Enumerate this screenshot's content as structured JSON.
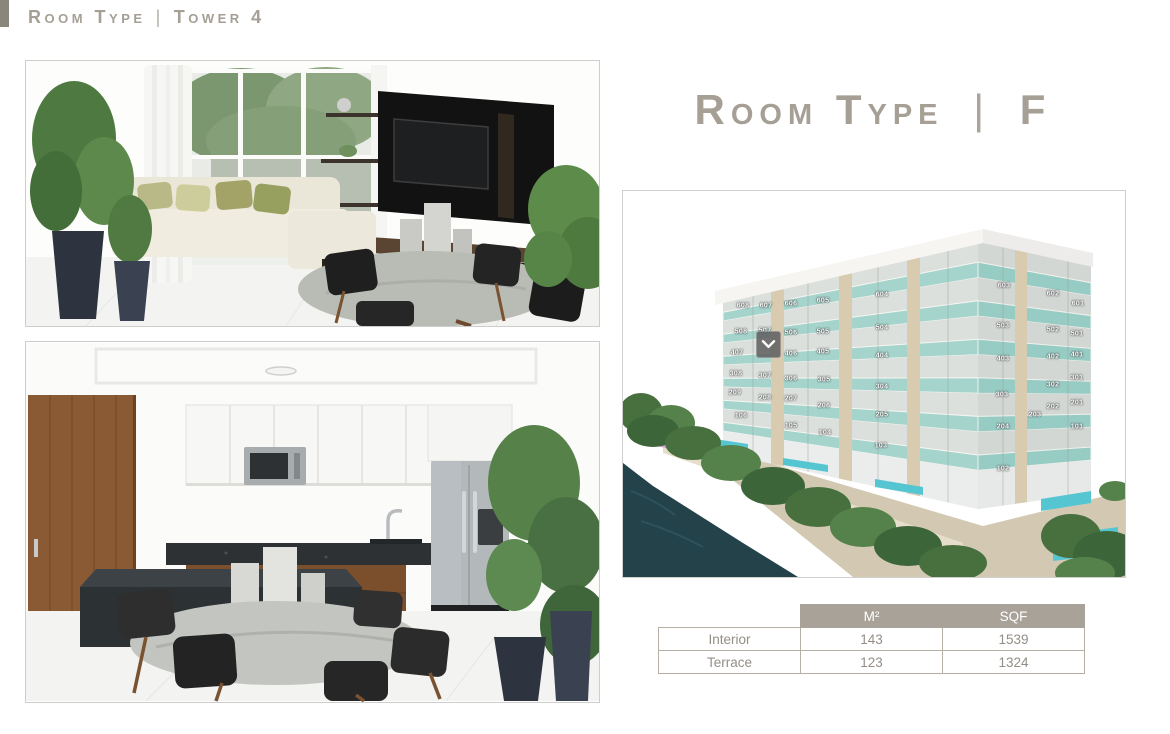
{
  "header": {
    "title_main": "Room Type",
    "divider": "|",
    "title_sub": "Tower 4"
  },
  "room": {
    "title_main": "Room Type",
    "divider": "|",
    "title_variant": "F"
  },
  "building": {
    "chevron_icon": "chevron-down",
    "units": [
      {
        "label": "608",
        "x": 120,
        "y": 115
      },
      {
        "label": "607",
        "x": 143,
        "y": 115
      },
      {
        "label": "606",
        "x": 168,
        "y": 113
      },
      {
        "label": "605",
        "x": 200,
        "y": 110
      },
      {
        "label": "604",
        "x": 259,
        "y": 104
      },
      {
        "label": "603",
        "x": 381,
        "y": 95
      },
      {
        "label": "602",
        "x": 430,
        "y": 103
      },
      {
        "label": "601",
        "x": 455,
        "y": 113
      },
      {
        "label": "508",
        "x": 118,
        "y": 141
      },
      {
        "label": "507",
        "x": 142,
        "y": 140
      },
      {
        "label": "506",
        "x": 168,
        "y": 142
      },
      {
        "label": "505",
        "x": 200,
        "y": 141
      },
      {
        "label": "504",
        "x": 259,
        "y": 137
      },
      {
        "label": "503",
        "x": 380,
        "y": 135
      },
      {
        "label": "502",
        "x": 430,
        "y": 139
      },
      {
        "label": "501",
        "x": 454,
        "y": 143
      },
      {
        "label": "407",
        "x": 114,
        "y": 162
      },
      {
        "label": "406",
        "x": 168,
        "y": 163
      },
      {
        "label": "405",
        "x": 200,
        "y": 161
      },
      {
        "label": "404",
        "x": 259,
        "y": 165
      },
      {
        "label": "403",
        "x": 380,
        "y": 168
      },
      {
        "label": "402",
        "x": 430,
        "y": 166
      },
      {
        "label": "401",
        "x": 454,
        "y": 164
      },
      {
        "label": "308",
        "x": 113,
        "y": 183
      },
      {
        "label": "307",
        "x": 142,
        "y": 185
      },
      {
        "label": "306",
        "x": 168,
        "y": 188
      },
      {
        "label": "305",
        "x": 201,
        "y": 189
      },
      {
        "label": "304",
        "x": 259,
        "y": 196
      },
      {
        "label": "303",
        "x": 379,
        "y": 204
      },
      {
        "label": "302",
        "x": 430,
        "y": 194
      },
      {
        "label": "301",
        "x": 454,
        "y": 187
      },
      {
        "label": "209",
        "x": 112,
        "y": 202
      },
      {
        "label": "208",
        "x": 142,
        "y": 207
      },
      {
        "label": "207",
        "x": 168,
        "y": 208
      },
      {
        "label": "206",
        "x": 201,
        "y": 215
      },
      {
        "label": "205",
        "x": 259,
        "y": 224
      },
      {
        "label": "204",
        "x": 380,
        "y": 236
      },
      {
        "label": "203",
        "x": 412,
        "y": 224
      },
      {
        "label": "202",
        "x": 430,
        "y": 216
      },
      {
        "label": "201",
        "x": 454,
        "y": 212
      },
      {
        "label": "106",
        "x": 118,
        "y": 225
      },
      {
        "label": "105",
        "x": 168,
        "y": 235
      },
      {
        "label": "104",
        "x": 202,
        "y": 242
      },
      {
        "label": "103",
        "x": 258,
        "y": 255
      },
      {
        "label": "102",
        "x": 380,
        "y": 278
      },
      {
        "label": "101",
        "x": 454,
        "y": 236
      }
    ]
  },
  "table": {
    "columns": [
      "M²",
      "SQF"
    ],
    "rows": [
      {
        "label": "Interior",
        "m2": "143",
        "sqf": "1539"
      },
      {
        "label": "Terrace",
        "m2": "123",
        "sqf": "1324"
      }
    ]
  },
  "colors": {
    "accent_text": "#a59f95",
    "table_header_bg": "#a8a299",
    "balcony_glass": "#a5d4cd",
    "pool_water": "#55c5d2",
    "sea_water": "#24424a",
    "pink_unit": "#d99fda"
  }
}
